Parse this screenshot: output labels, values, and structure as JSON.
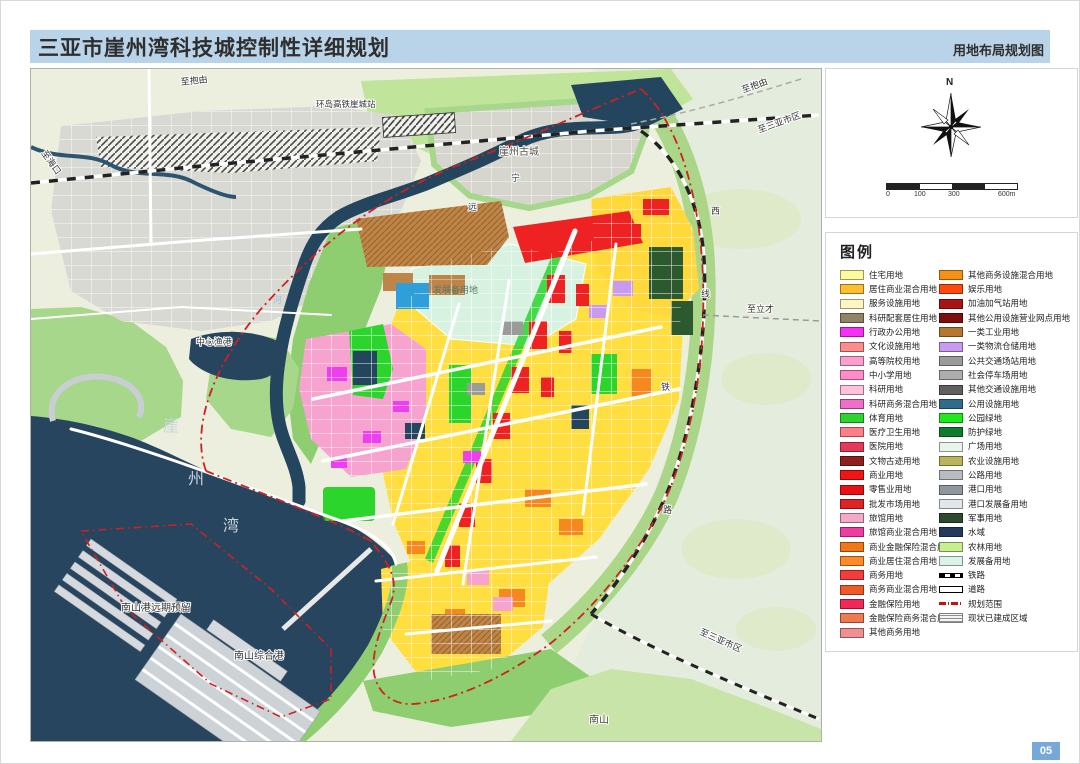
{
  "header": {
    "title": "三亚市崖州湾科技城控制性详细规划",
    "subtitle": "用地布局规划图"
  },
  "page_number": "05",
  "compass": {
    "north_label": "N",
    "scale_ticks": [
      "0",
      "100",
      "300",
      "600m"
    ]
  },
  "legend": {
    "title": "图例",
    "left": [
      {
        "label": "住宅用地",
        "color": "#FFFA9E"
      },
      {
        "label": "居住商业混合用地",
        "color": "#FFBE2D"
      },
      {
        "label": "服务设施用地",
        "color": "#FFF7C2"
      },
      {
        "label": "科研配套居住用地",
        "color": "#918465"
      },
      {
        "label": "行政办公用地",
        "color": "#F431F4"
      },
      {
        "label": "文化设施用地",
        "color": "#FF8C8C"
      },
      {
        "label": "高等院校用地",
        "color": "#FF9ECE"
      },
      {
        "label": "中小学用地",
        "color": "#FF8CC6"
      },
      {
        "label": "科研用地",
        "color": "#FFC2DC"
      },
      {
        "label": "科研商务混合用地",
        "color": "#F06EC8"
      },
      {
        "label": "体育用地",
        "color": "#2FD32F"
      },
      {
        "label": "医疗卫生用地",
        "color": "#FF7F86"
      },
      {
        "label": "医院用地",
        "color": "#E8385A"
      },
      {
        "label": "文物古迹用地",
        "color": "#8E1F1F"
      },
      {
        "label": "商业用地",
        "color": "#F01414"
      },
      {
        "label": "零售业用地",
        "color": "#E81010"
      },
      {
        "label": "批发市场用地",
        "color": "#E02222"
      },
      {
        "label": "旅馆用地",
        "color": "#F6A8C8"
      },
      {
        "label": "旅馆商业混合用地",
        "color": "#F03CA0"
      },
      {
        "label": "商业金融保险混合用地",
        "color": "#F07818"
      },
      {
        "label": "商业居住混合用地",
        "color": "#FF8A2A"
      },
      {
        "label": "商务用地",
        "color": "#F43C3C"
      },
      {
        "label": "商务商业混合用地",
        "color": "#F05A28"
      },
      {
        "label": "金融保险用地",
        "color": "#F02858"
      },
      {
        "label": "金融保险商务混合用地",
        "color": "#F07A50"
      },
      {
        "label": "其他商务用地",
        "color": "#F09090"
      }
    ],
    "right": [
      {
        "label": "其他商务设施混合用地",
        "color": "#F59116"
      },
      {
        "label": "娱乐用地",
        "color": "#FF4A10"
      },
      {
        "label": "加油加气站用地",
        "color": "#A81414"
      },
      {
        "label": "其他公用设施营业网点用地",
        "color": "#7C0E0E"
      },
      {
        "label": "一类工业用地",
        "color": "#B5762F"
      },
      {
        "label": "一类物流仓储用地",
        "color": "#C89BF0"
      },
      {
        "label": "公共交通场站用地",
        "color": "#9B9B9B"
      },
      {
        "label": "社会停车场用地",
        "color": "#ADADAD"
      },
      {
        "label": "其他交通设施用地",
        "color": "#606060"
      },
      {
        "label": "公用设施用地",
        "color": "#2F6C8C"
      },
      {
        "label": "公园绿地",
        "color": "#1FE81F"
      },
      {
        "label": "防护绿地",
        "color": "#0F7D2D"
      },
      {
        "label": "广场用地",
        "color": "#EAF5EA"
      },
      {
        "label": "农业设施用地",
        "color": "#B9B45C"
      },
      {
        "label": "公路用地",
        "color": "#B8BCC0"
      },
      {
        "label": "港口用地",
        "color": "#8E979E"
      },
      {
        "label": "港口发展备用地",
        "color": "#DFE7EC"
      },
      {
        "label": "军事用地",
        "color": "#2C4A2E"
      },
      {
        "label": "水域",
        "color": "#24395C"
      },
      {
        "label": "农林用地",
        "color": "#C6EF8E"
      },
      {
        "label": "发展备用地",
        "color": "#D9F3E6"
      },
      {
        "label": "铁路",
        "type": "rail"
      },
      {
        "label": "道路",
        "type": "road"
      },
      {
        "label": "规划范围",
        "type": "boundary"
      },
      {
        "label": "现状已建成区域",
        "type": "hatch"
      }
    ]
  },
  "map_labels": {
    "to_haikou": "至海口",
    "to_baoyou_left": "至抱由",
    "station": "环岛高铁崖城站",
    "old_town": "崖州古城",
    "to_baoyou_right": "至抱由",
    "to_sanya_top": "至三亚市区",
    "river_chars": [
      "宁",
      "远",
      "河"
    ],
    "rail_chars": [
      "西",
      "线",
      "铁",
      "路"
    ],
    "to_licai": "至立才",
    "fishing_port": "中心渔港",
    "bay_chars": [
      "崖",
      "州",
      "湾"
    ],
    "reserve_area": "发展备用地",
    "nanshan_port_reserve": "南山港远期预留",
    "nanshan_comprehensive_port": "南山综合港",
    "to_sanya_bottom": "至三亚市区",
    "nanshan": "南山"
  }
}
